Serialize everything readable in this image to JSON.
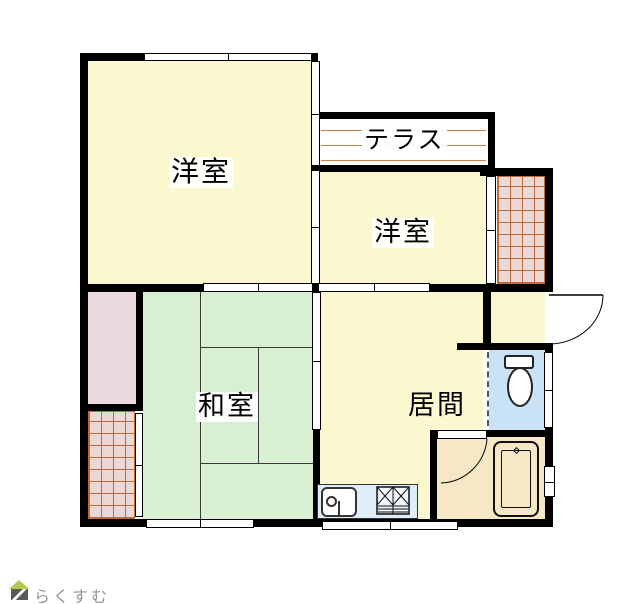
{
  "floorplan": {
    "rooms": {
      "western1": "洋室",
      "terrace": "テラス",
      "western2": "洋室",
      "japanese": "和室",
      "living": "居間"
    },
    "logo": "らくすむ",
    "colors": {
      "room-yellow": "#FBF8D0",
      "room-green": "#D8EFD2",
      "room-pink": "#EADADD",
      "balcony-bg": "#EAD8D7",
      "balcony-grid": "#C2693B",
      "toilet-blue": "#C9E2F6",
      "kitchen-blue": "#DFEDF7",
      "bath-peach": "#F6E7C5",
      "terrace-line": "#C78347",
      "wall-black": "#000000",
      "logo-gray": "#98968F",
      "logo-roof": "#B5C94F",
      "logo-body": "#5A5A56"
    }
  }
}
